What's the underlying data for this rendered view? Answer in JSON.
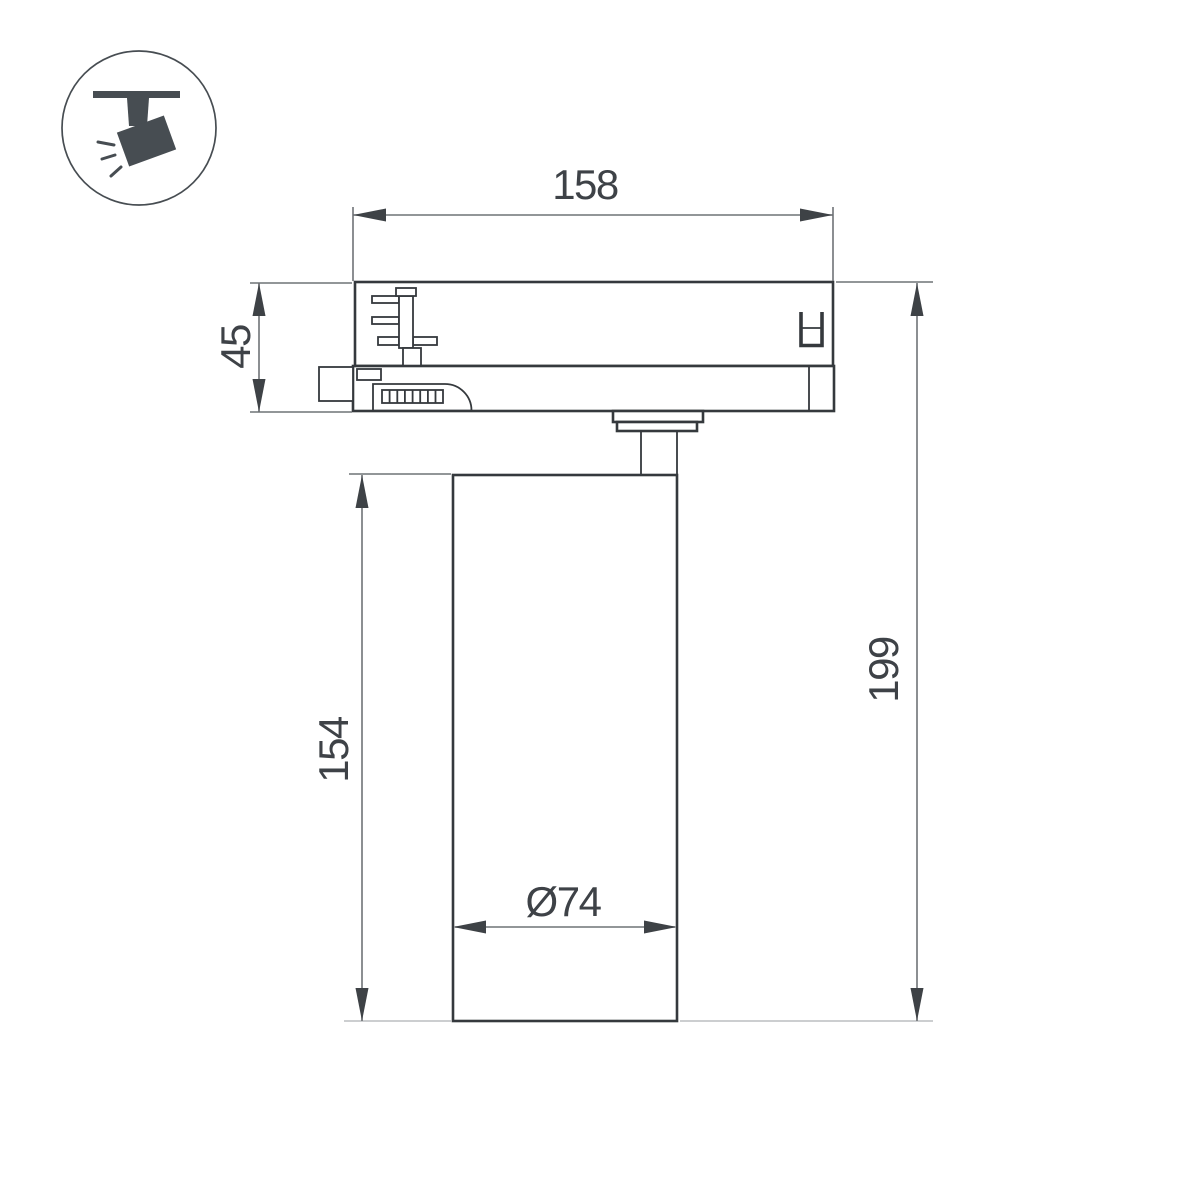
{
  "drawing": {
    "type": "technical-dimension-drawing",
    "subject": "track-mounted spotlight, side view"
  },
  "dimensions": {
    "track_width": "158",
    "adapter_height": "45",
    "total_height": "199",
    "body_height": "154",
    "body_diameter": "Ø74"
  },
  "colors": {
    "page_bg": "#ffffff",
    "outline": "#35393d",
    "dimension": "#6f7377",
    "extension_light": "#bcbec0",
    "arrow": "#3e4246",
    "text": "#3e4247",
    "icon": "#474d52"
  }
}
